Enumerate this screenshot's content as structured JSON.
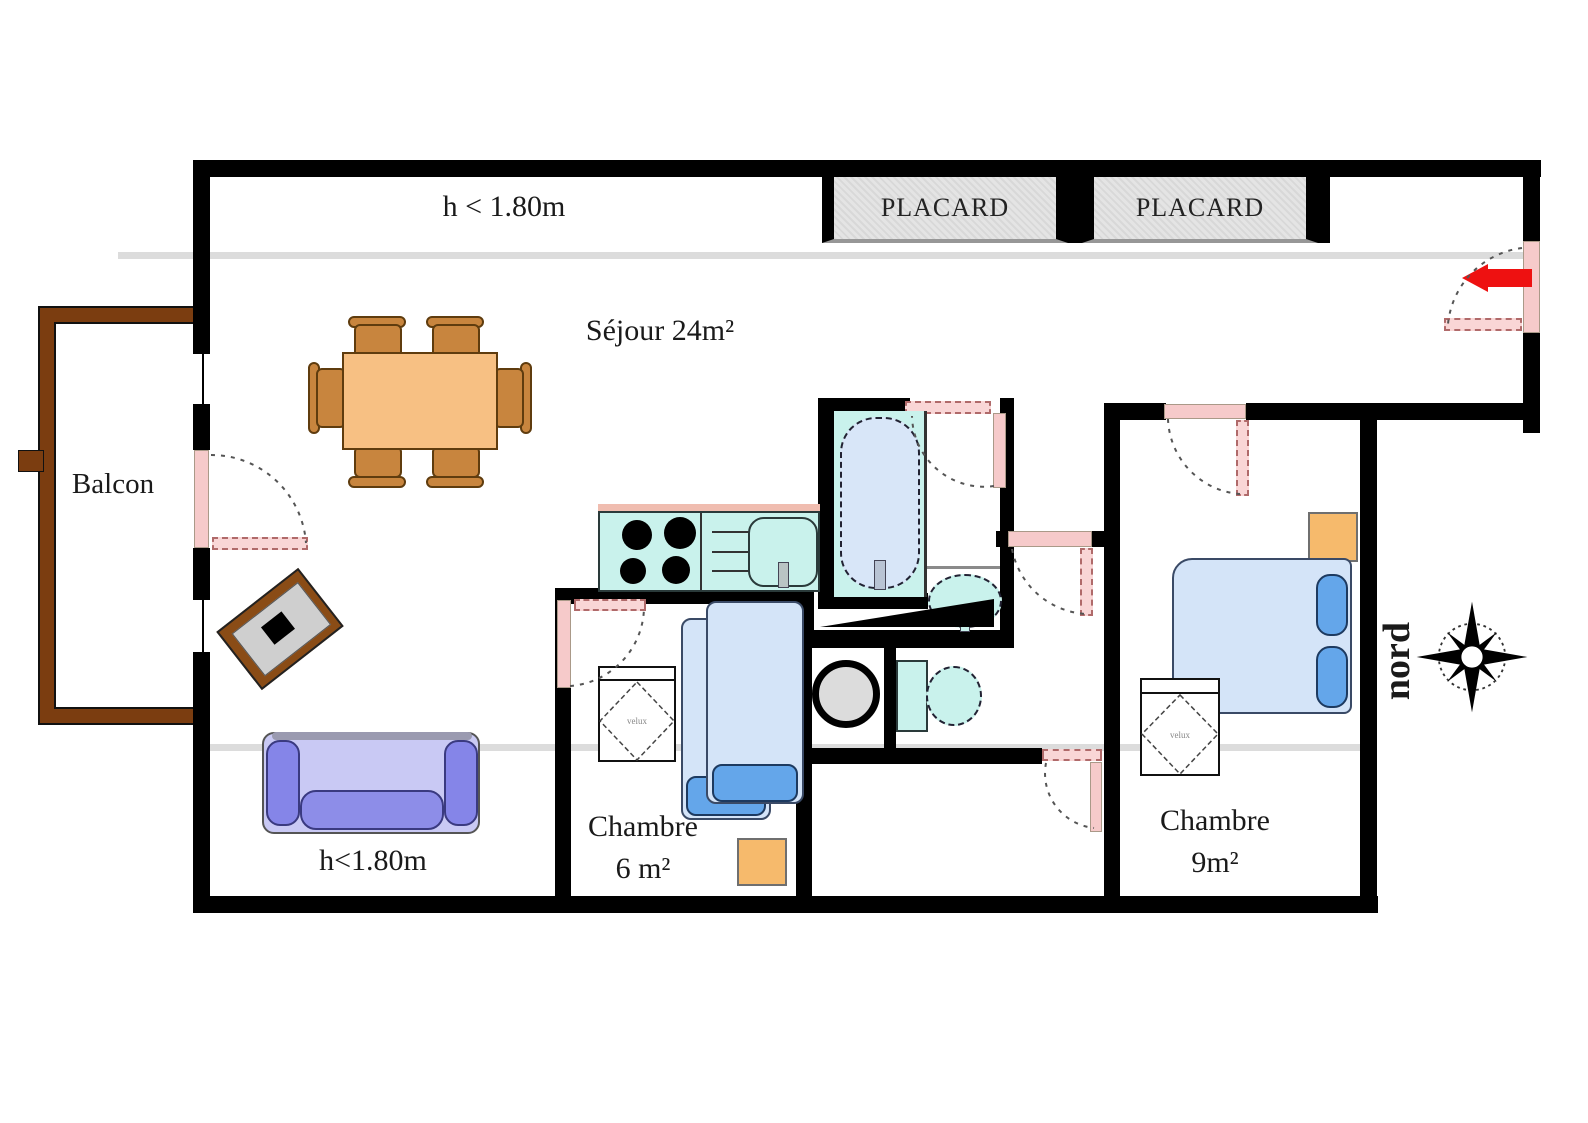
{
  "plan": {
    "title": "apartment-floor-plan",
    "north_label": "nord",
    "annotations": {
      "low_ceiling_top": "h < 1.80m",
      "low_ceiling_bottom": "h<1.80m"
    },
    "rooms": {
      "living": {
        "label": "Séjour 24m²"
      },
      "balcony": {
        "label": "Balcon"
      },
      "bedroom_small": {
        "name": "Chambre",
        "area": "6 m²"
      },
      "bedroom_large": {
        "name": "Chambre",
        "area": "9m²"
      }
    },
    "closets": [
      "PLACARD",
      "PLACARD"
    ],
    "roof_windows": [
      "velux",
      "velux"
    ],
    "colors": {
      "wall": "#000000",
      "door_pink": "#f6caca",
      "balcony_wood": "#7b3d10",
      "table_wood": "#f7c083",
      "chair_wood": "#c8853e",
      "bed_fill": "#d4e4f8",
      "pillow_fill": "#64a6ea",
      "sofa_body": "#c9c9f4",
      "sofa_trim": "#8585e8",
      "fixture_cyan": "#c9f2ec",
      "tub_fill": "#d8e6f8",
      "appliance_gray": "#dcdcdc",
      "closet_fill": "#e4e4e4",
      "nightstand_orange": "#f6ba6c",
      "entry_arrow_red": "#ee1111",
      "low_ceiling_line": "#dcdcdc"
    }
  }
}
